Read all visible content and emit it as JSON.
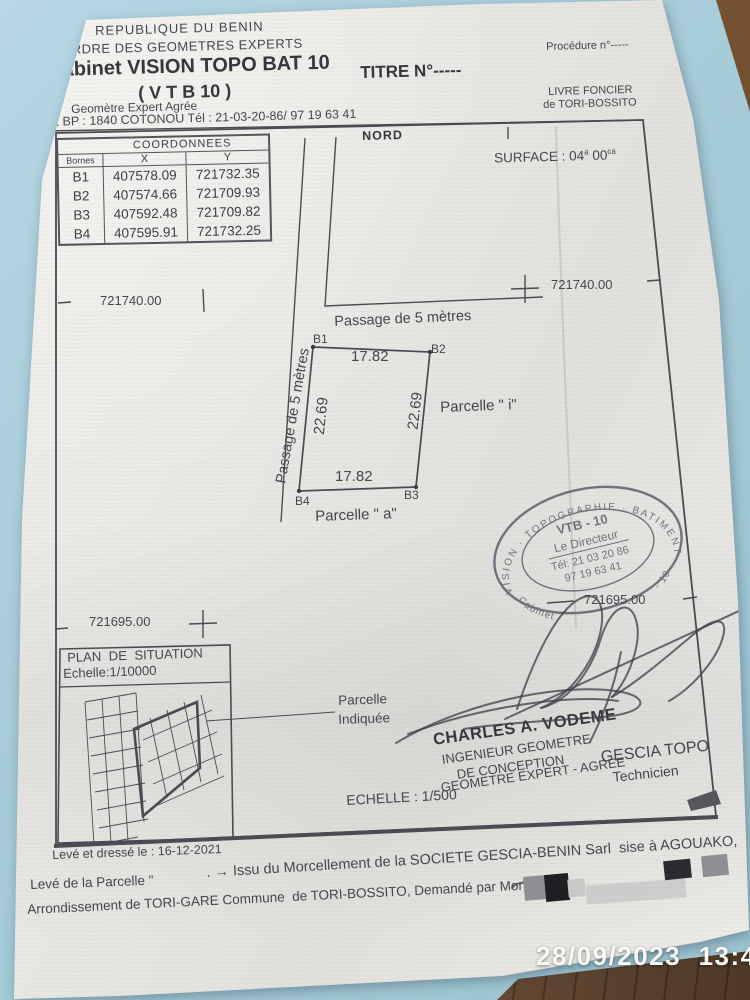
{
  "header": {
    "line1": "REPUBLIQUE DU BENIN",
    "line2": "ORDRE DES GEOMETRES EXPERTS",
    "cabinet": "Cabinet VISION TOPO BAT 10",
    "titre": "TITRE N°-----",
    "procedure": "Procédure n°-----",
    "vtb": "( V T B 10 )",
    "livre_foncier_1": "LIVRE FONCIER",
    "livre_foncier_2": "de TORI-BOSSITO",
    "geometre": "Geomètre Expert Agrée",
    "address": "02 BP : 1840 COTONOU Tél : 21-03-20-86/ 97 19 63 41"
  },
  "coordinates_table": {
    "title": "COORDONNEES",
    "col_bornes": "Bornes",
    "col_x": "X",
    "col_y": "Y",
    "rows": [
      {
        "borne": "B1",
        "x": "407578.09",
        "y": "721732.35"
      },
      {
        "borne": "B2",
        "x": "407574.66",
        "y": "721709.93"
      },
      {
        "borne": "B3",
        "x": "407592.48",
        "y": "721709.82"
      },
      {
        "borne": "B4",
        "x": "407595.91",
        "y": "721732.25"
      }
    ]
  },
  "plan": {
    "nord": "NORD",
    "surface_label": "SURFACE :",
    "surface_value": "04",
    "surface_unit": "a",
    "surface_value2": "00",
    "surface_unit2": "ca",
    "grid_y_top": "721740.00",
    "grid_y_bottom": "721695.00",
    "passage_top": "Passage de 5 mètres",
    "passage_left": "Passage de 5 mètres",
    "b1": "B1",
    "b2": "B2",
    "b3": "B3",
    "b4": "B4",
    "dim_top": "17.82",
    "dim_bottom": "17.82",
    "dim_left": "22.69",
    "dim_right": "22.69",
    "parcelle_i": "Parcelle \" i\"",
    "parcelle_a": "Parcelle \" a\""
  },
  "situation": {
    "title": "PLAN DE SITUATION",
    "echelle": "Echelle:1/10000",
    "callout1": "Parcelle",
    "callout2": "Indiquée"
  },
  "stamp": {
    "ring_top": "VISION · TOPOGRAPHIE · BATIMENT",
    "ring_bottom_left": "Cabinet",
    "ring_bottom_right": "- 10",
    "center1": "VTB - 10",
    "center2": "Le Directeur",
    "center3": "Tél: 21 03 20 86",
    "center4": "97 19 63 41"
  },
  "credits": {
    "name": "CHARLES A. VODEME",
    "role1": "INGENIEUR GEOMETRE",
    "role2": "DE CONCEPTION",
    "role3": "GEOMETRE EXPERT - AGREE",
    "org": "GESCIA TOPO",
    "org_role": "Technicien",
    "echelle": "ECHELLE : 1/500"
  },
  "footer": {
    "leve_dresse": "Levé et dressé le : 16-12-2021",
    "leve_parcelle": "Levé de la Parcelle \"",
    "morcellement": ". → Issu du Morcellement de la SOCIETE GESCIA-BENIN Sarl  sise à AGOUAKO,",
    "arrondissement": "Arrondissement de TORI-GARE Commune  de TORI-BOSSITO, Demandé par Monsieur . –"
  },
  "camera_timestamp": "28/09/2023  13:46"
}
